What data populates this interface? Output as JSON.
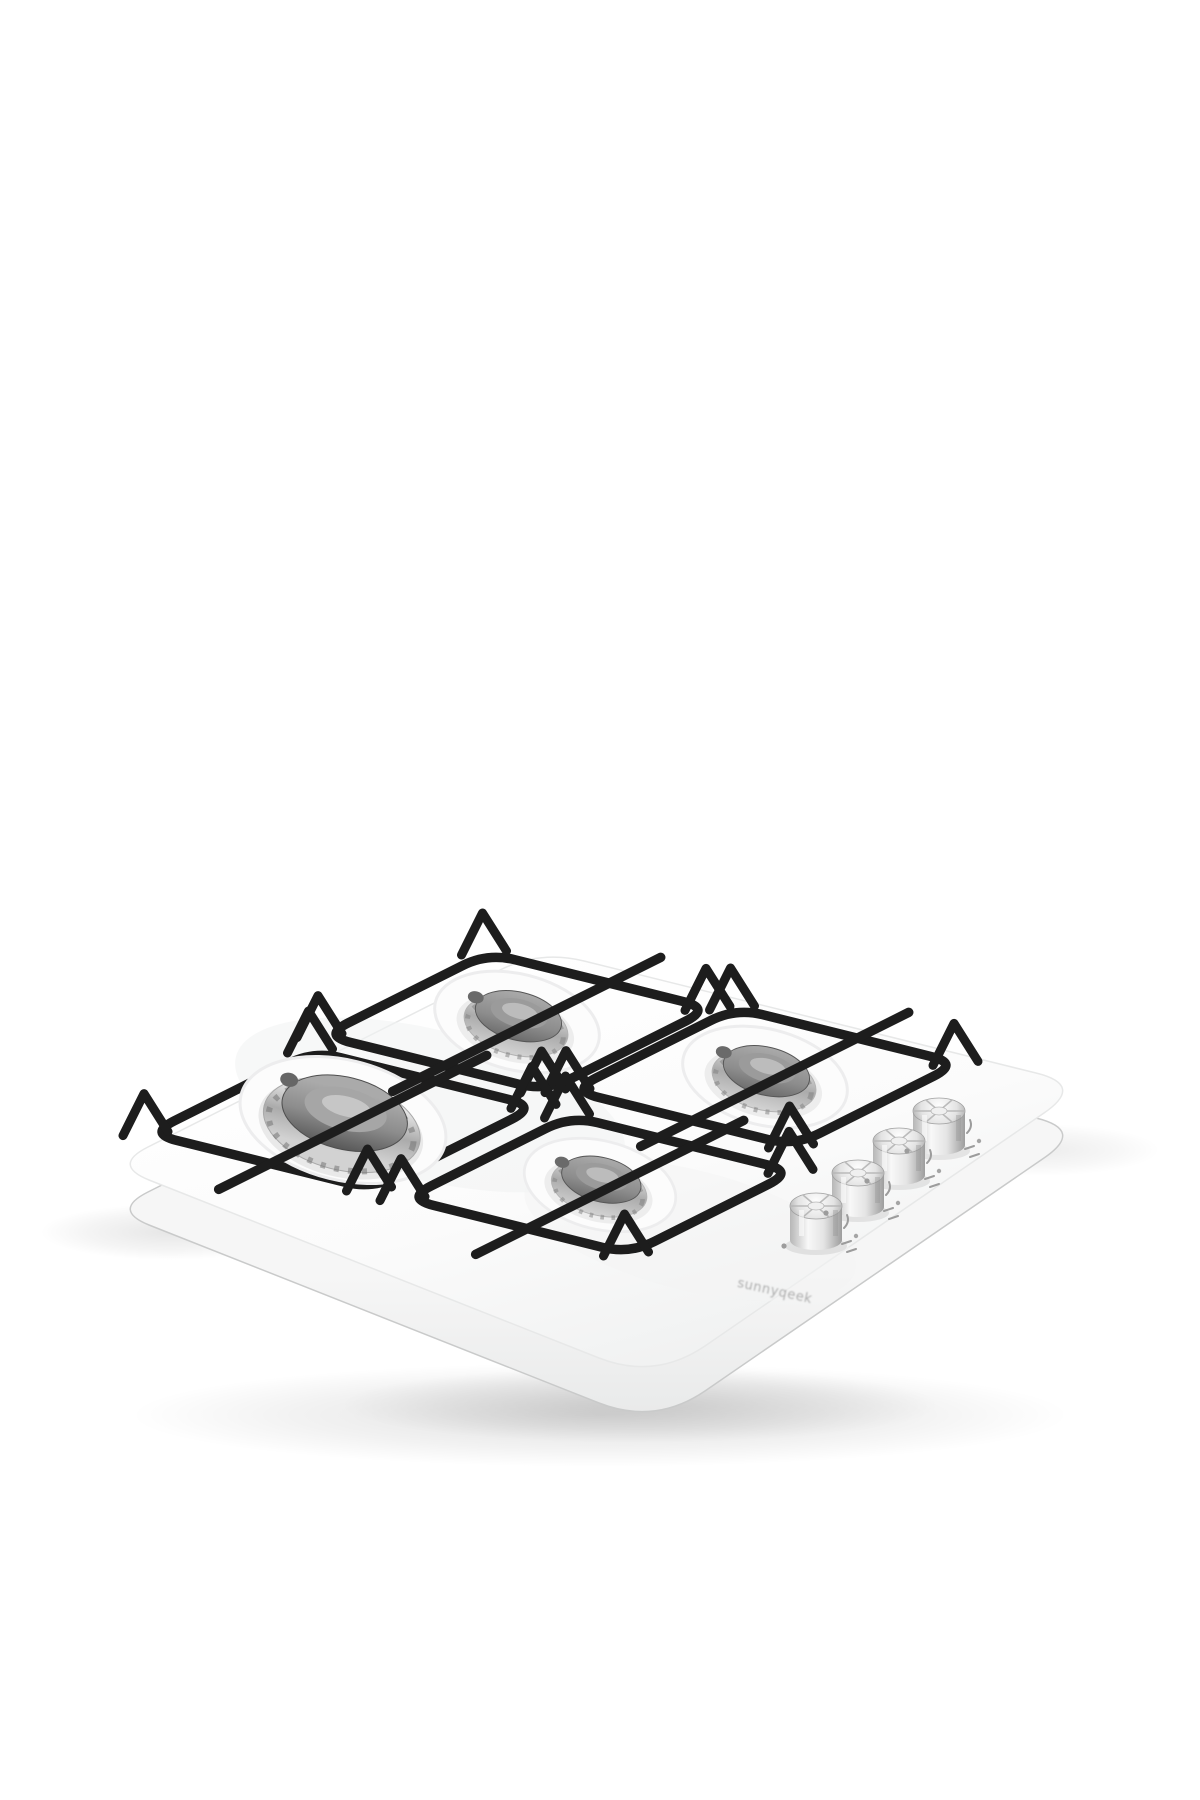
{
  "page": {
    "background_color": "#ffffff"
  },
  "product": {
    "title": "White four-burner gas hob",
    "description": "Three-quarter product photo of a white built-in gas cooktop with four burners, black enamel pan supports with raised corner posts, and four chrome fluted control knobs along the right front edge.",
    "brand_text": "sunnyqeek",
    "view": "three-quarter elevated",
    "colors": {
      "body": "#fafafa",
      "side_face": "#e7e8e8",
      "ground_shadow": "#dcdcdc",
      "pan_support": "#1d1d1d",
      "burner_cap": "#8a8a8a",
      "burner_ring_chrome": "#c9c9c9",
      "knob_chrome": "#d9d9d9",
      "panel_markings": "#9c9c9c"
    },
    "burners": [
      {
        "id": "rear-left",
        "size": "medium"
      },
      {
        "id": "rear-right",
        "size": "medium"
      },
      {
        "id": "front-left",
        "size": "large"
      },
      {
        "id": "front-right",
        "size": "small"
      }
    ],
    "knobs": [
      {
        "id": "knob-1",
        "position": "front-most"
      },
      {
        "id": "knob-2",
        "position": "second"
      },
      {
        "id": "knob-3",
        "position": "third"
      },
      {
        "id": "knob-4",
        "position": "rear-most"
      }
    ]
  }
}
